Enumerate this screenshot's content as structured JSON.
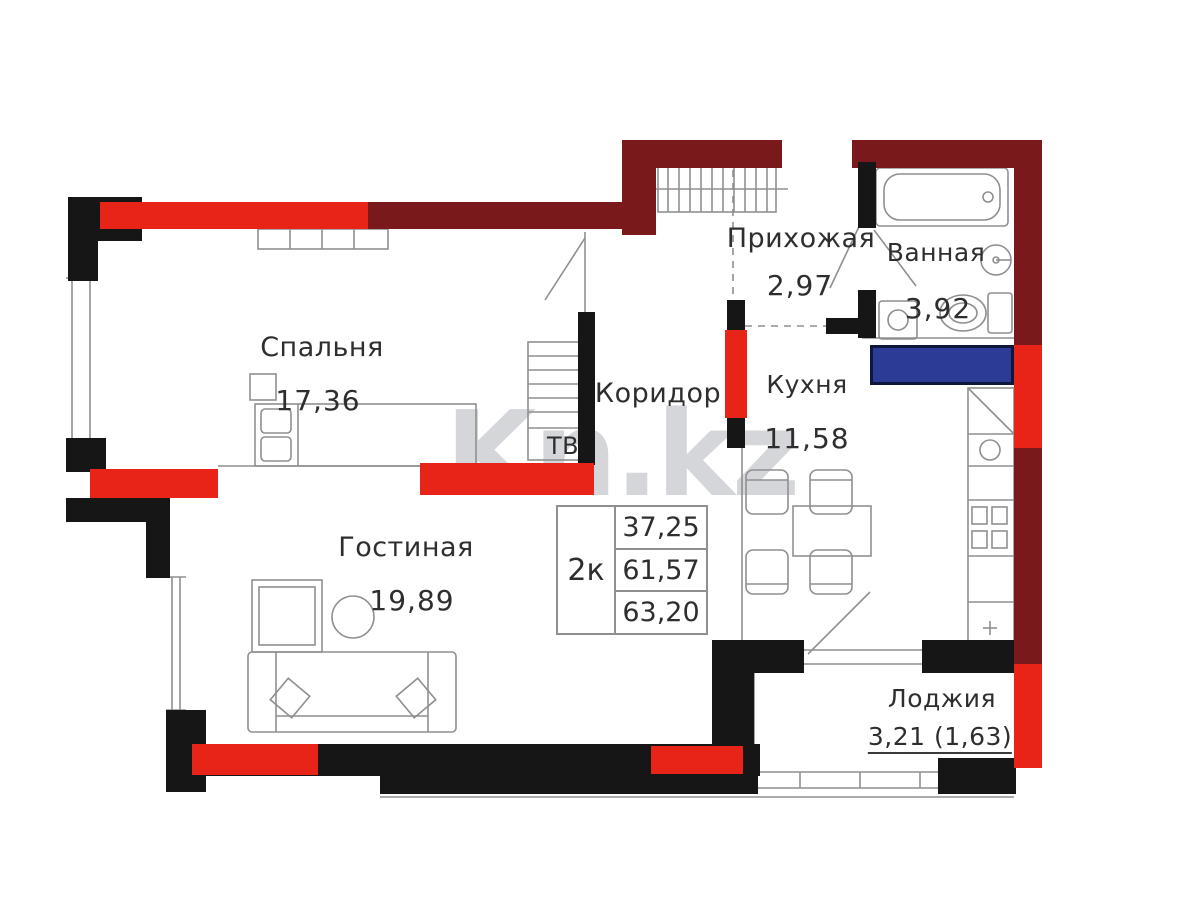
{
  "plan": {
    "watermark": "Kn.kz",
    "unit_table": {
      "type": "2к",
      "rows": [
        "37,25",
        "61,57",
        "63,20"
      ]
    },
    "rooms": {
      "bedroom": {
        "name": "Спальня",
        "area": "17,36"
      },
      "living": {
        "name": "Гостиная",
        "area": "19,89"
      },
      "corridor": {
        "name": "Коридор"
      },
      "hallway": {
        "name": "Прихожая",
        "area": "2,97"
      },
      "bathroom": {
        "name": "Ванная",
        "area": "3,92"
      },
      "kitchen": {
        "name": "Кухня",
        "area": "11,58"
      },
      "loggia": {
        "name": "Лоджия",
        "area": "3,21 (1,63)"
      }
    },
    "furniture_labels": {
      "tv": "ТВ"
    },
    "colors": {
      "wall_dark_red": "#7a191b",
      "wall_red": "#e82418",
      "wall_black": "#161616",
      "shaft_blue": "#2c3b96"
    }
  }
}
